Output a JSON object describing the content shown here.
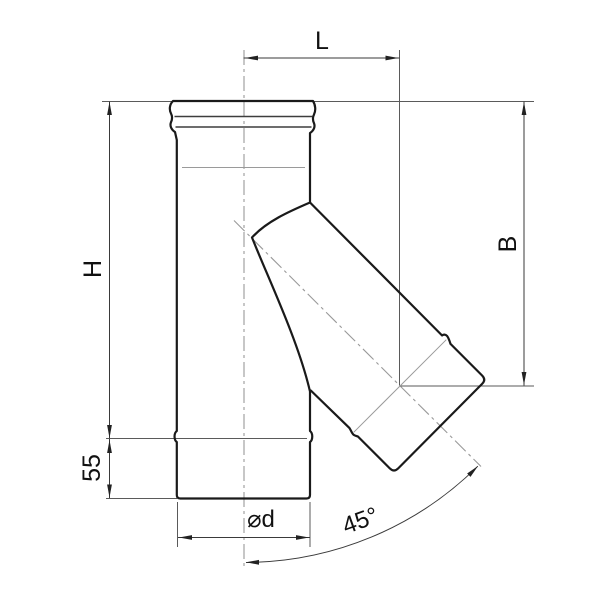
{
  "drawing": {
    "type": "technical-dimension-drawing",
    "subject": "45-degree pipe tee fitting (flue/chimney tee), side view with dimension callouts",
    "dimensions": {
      "top_length": {
        "label": "L",
        "measures": "horizontal distance from vertical pipe centerline to branch outlet center"
      },
      "overall_height": {
        "label": "H",
        "measures": "vertical distance from pipe top to lower section joint"
      },
      "branch_drop": {
        "label": "B",
        "measures": "vertical distance from pipe top to branch outlet centerline"
      },
      "bottom_section": {
        "label": "55",
        "measures": "height of lower pipe section"
      },
      "diameter": {
        "label": "⌀d",
        "measures": "pipe outer diameter"
      },
      "angle": {
        "label": "45°",
        "measures": "branch angle from vertical pipe axis"
      }
    },
    "colors": {
      "background": "#ffffff",
      "outline": "#1a1a1a",
      "dimension_lines": "#3a3a3a",
      "centerlines": "#999999"
    }
  }
}
